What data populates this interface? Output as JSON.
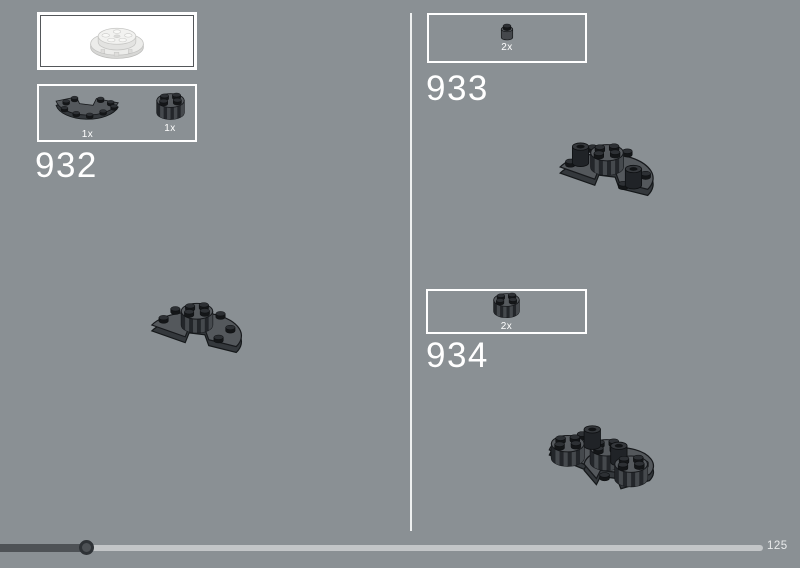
{
  "steps": [
    {
      "number": "932",
      "parts": [
        {
          "count": "1x",
          "name": "plate-round-half-dark-gray"
        },
        {
          "count": "1x",
          "name": "round-brick-2x2-grille-dark-gray"
        }
      ]
    },
    {
      "number": "933",
      "parts": [
        {
          "count": "2x",
          "name": "round-brick-1x1-black"
        }
      ]
    },
    {
      "number": "934",
      "parts": [
        {
          "count": "2x",
          "name": "round-brick-2x2-grille-dark-gray"
        }
      ]
    }
  ],
  "scale_box": {
    "part": "turntable-round-white-actual-size"
  },
  "progress": {
    "page_label": "125"
  },
  "colors": {
    "background": "#8a9094",
    "box_border": "#ffffff",
    "track_light": "#c3c6c8",
    "track_dark": "#4e5256",
    "piece_top": "#5b5f63",
    "piece_side": "#3e4246",
    "stud_black": "#17191c"
  }
}
